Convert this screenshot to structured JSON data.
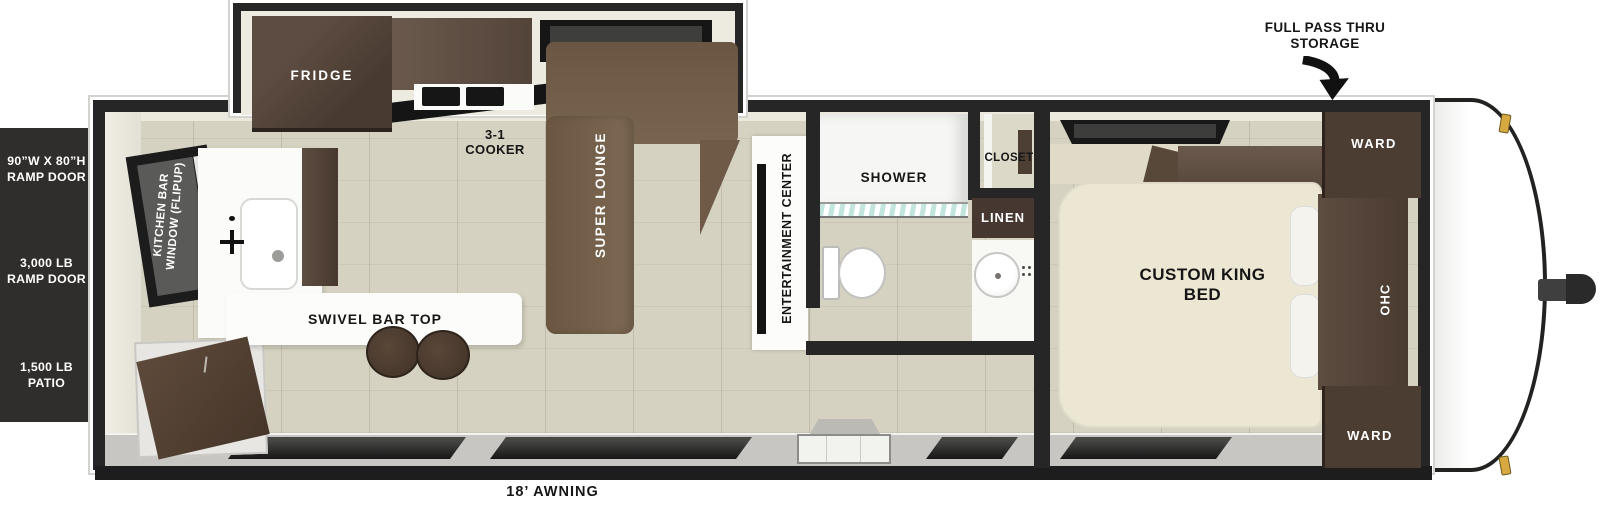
{
  "document": {
    "type": "travel trailer floorplan (top view)"
  },
  "callouts": {
    "storage": "FULL PASS THRU STORAGE",
    "awning": "18’ AWNING",
    "ramp_door_size": "90”W X 80”H RAMP DOOR",
    "ramp_door_capacity": "3,000 LB RAMP DOOR",
    "patio_capacity": "1,500 LB PATIO"
  },
  "kitchen": {
    "fridge": "FRIDGE",
    "cooker": "3-1 COOKER",
    "window": "KITCHEN BAR WINDOW (FLIPUP)",
    "bar_top": "SWIVEL BAR TOP"
  },
  "living": {
    "sofa": "SUPER LOUNGE",
    "entertainment": "ENTERTAINMENT CENTER"
  },
  "bathroom": {
    "shower": "SHOWER",
    "closet": "CLOSET",
    "linen": "LINEN"
  },
  "bedroom": {
    "bed": "CUSTOM KING BED",
    "ward_top": "WARD",
    "ward_bottom": "WARD",
    "ohc": "OHC"
  },
  "colors": {
    "wall": "#262626",
    "floor": "#d6d2c1",
    "cabinet_dark": "#4c3d33",
    "sofa": "#74604b",
    "bed": "#ebe7d3",
    "shower_glass": "#bfe4dc",
    "marker_light": "#d8a841",
    "exterior_band": "#c8c6c2"
  }
}
